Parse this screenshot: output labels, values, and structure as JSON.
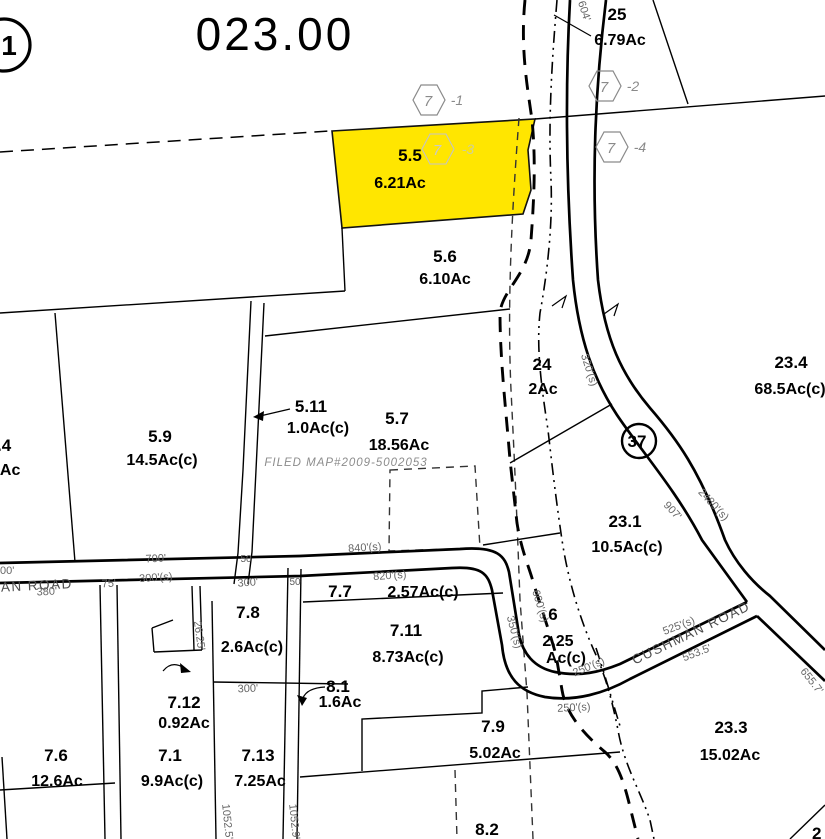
{
  "map": {
    "sheet_number": "023.00",
    "corner_circle": "1",
    "route_shield": "37",
    "filed_map_note": "FILED MAP#2009-5002053",
    "highlight_color": "#ffe600"
  },
  "roads": {
    "cushman_west": "CUSHMAN ROAD",
    "cushman_east": "CUSHMAN ROAD"
  },
  "hex_refs": [
    {
      "num": "7",
      "suffix": "-1"
    },
    {
      "num": "7",
      "suffix": "-2"
    },
    {
      "num": "7",
      "suffix": "-3"
    },
    {
      "num": "7",
      "suffix": "-4"
    }
  ],
  "parcels": {
    "p5_5": {
      "num": "5.5",
      "area": "6.21Ac"
    },
    "p5_6": {
      "num": "5.6",
      "area": "6.10Ac"
    },
    "p5_7": {
      "num": "5.7",
      "area": "18.56Ac"
    },
    "p5_9": {
      "num": "5.9",
      "area": "14.5Ac(c)"
    },
    "p5_11": {
      "num": "5.11",
      "area": "1.0Ac(c)"
    },
    "p24": {
      "num": "24",
      "area": "2Ac"
    },
    "p25": {
      "num": "25",
      "area": "6.79Ac"
    },
    "p23_1": {
      "num": "23.1",
      "area": "10.5Ac(c)"
    },
    "p23_3": {
      "num": "23.3",
      "area": "15.02Ac"
    },
    "p23_4": {
      "num": "23.4",
      "area": "68.5Ac(c)"
    },
    "p6": {
      "num": "6",
      "area1": "2.25",
      "area2": "Ac(c)"
    },
    "p7_1": {
      "num": "7.1",
      "area": "9.9Ac(c)"
    },
    "p7_6": {
      "num": "7.6",
      "area": "12.6Ac"
    },
    "p7_7": {
      "num": "7.7",
      "area": "2.57Ac(c)"
    },
    "p7_8": {
      "num": "7.8",
      "area": "2.6Ac(c)"
    },
    "p7_9": {
      "num": "7.9",
      "area": "5.02Ac"
    },
    "p7_11": {
      "num": "7.11",
      "area": "8.73Ac(c)"
    },
    "p7_12": {
      "num": "7.12",
      "area": "0.92Ac"
    },
    "p7_13": {
      "num": "7.13",
      "area": "7.25Ac"
    },
    "p8_1": {
      "num": "8.1",
      "area": "1.6Ac"
    },
    "p8_2": {
      "num": "8.2"
    }
  },
  "partials": {
    "left_parcel_num": ".4",
    "left_parcel_area": "9Ac",
    "left_dim": "00'",
    "corner_parcel_num": "2"
  },
  "dims": {
    "d700": "700'",
    "d50a": "50",
    "d840s": "840'(s)",
    "d820s": "820'(s)",
    "d300s": "300'(s)",
    "d380": "380'",
    "d75": "75'",
    "d300road": "300'",
    "d50b": "50",
    "d300b": "300'",
    "d2625": "26.25'",
    "d604": "604'",
    "d320s": "320'(s)",
    "d2480s": "2480'(s)",
    "d907": "907'",
    "d600s": "600'(s)",
    "d350s": "350'(s)",
    "d250sa": "250'(s)",
    "d250sb": "250'(s)",
    "d525s": "525'(s)",
    "d5535": "553.5'",
    "d6557": "655.7'",
    "d1052_5": "1052.5'",
    "d1052_9": "1052.9'"
  }
}
